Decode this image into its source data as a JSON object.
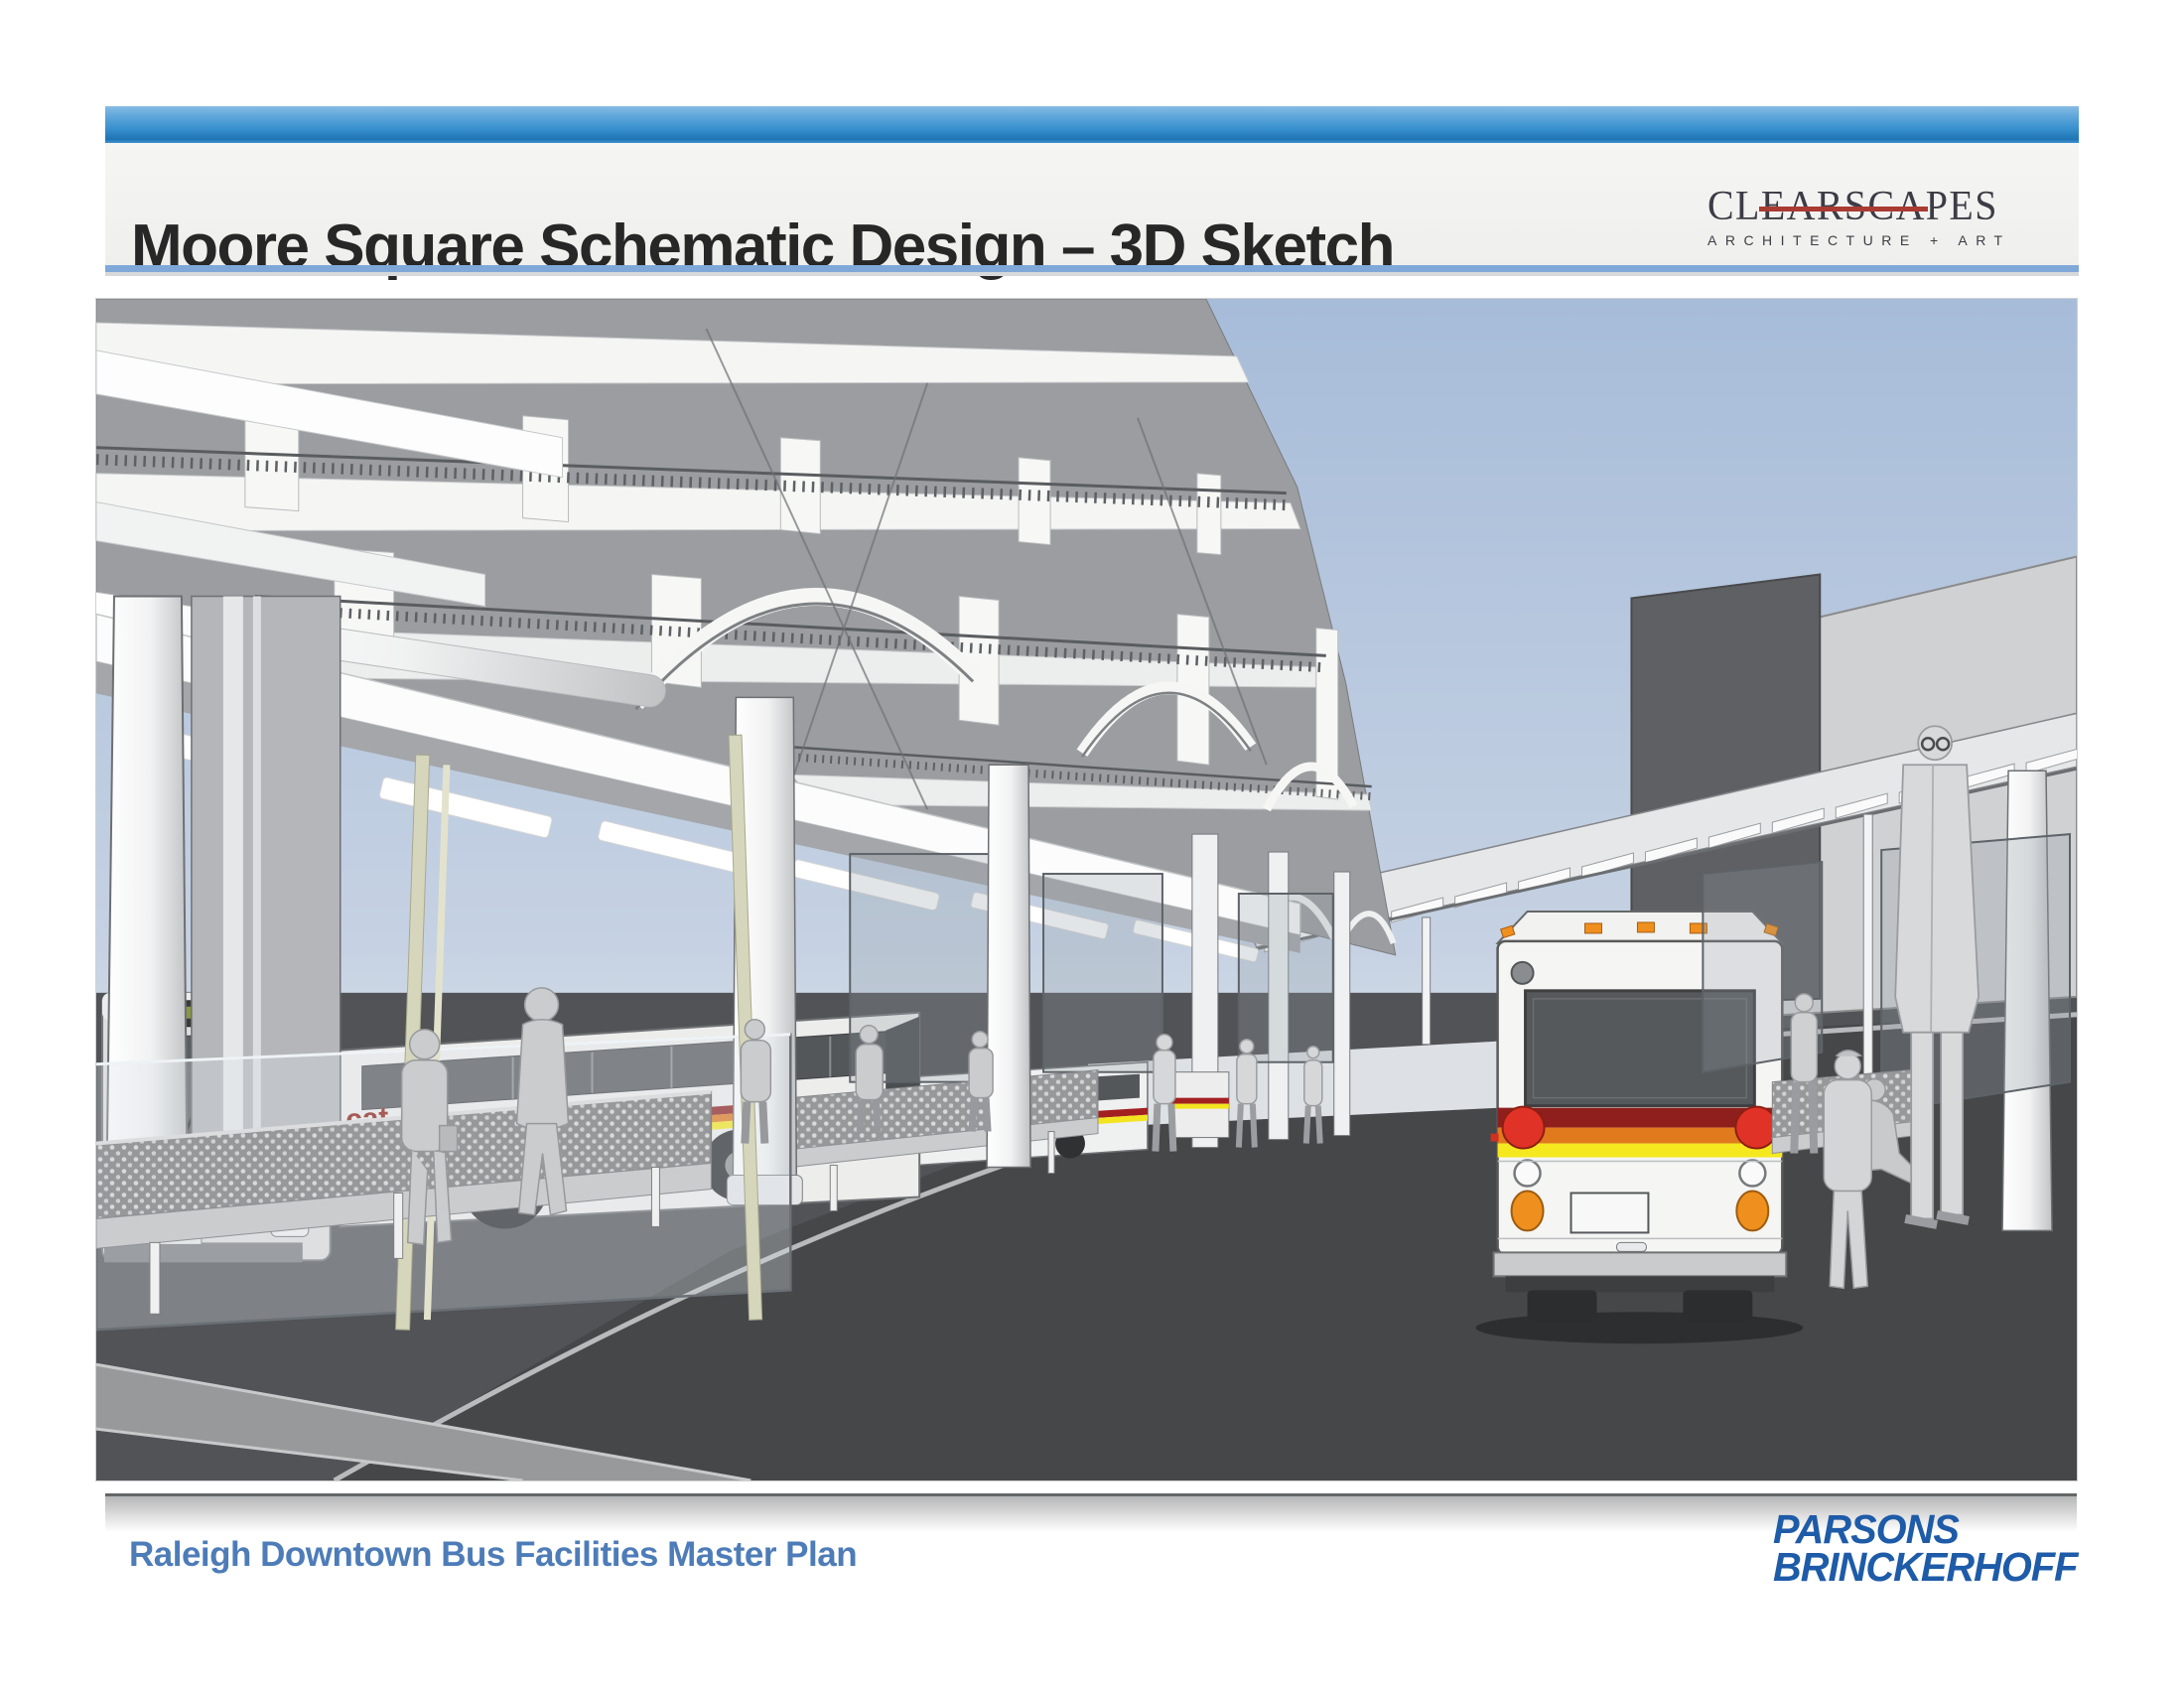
{
  "header": {
    "title": "Moore Square Schematic Design – 3D Sketch"
  },
  "clearscapes_logo": {
    "wordmark": "CLEARSCAPES",
    "tagline": "ARCHITECTURE + ART",
    "accent_color": "#a93b33",
    "text_color": "#3d3c46"
  },
  "sketch": {
    "bus_side_label": "cat"
  },
  "palette": {
    "header_bar_blue": "#3890cd",
    "title_rule_blue": "#7fa8d9",
    "sky_top": "#a7bcd9",
    "road_dark": "#47494b",
    "structure_gray": "#9b9da0",
    "stripe_dark_red": "#8e1f1c",
    "stripe_orange": "#e07a1c",
    "stripe_yellow": "#f5e81f",
    "cat_red": "#8d1d12",
    "tail_light_red": "#e03227",
    "marker_orange": "#ef8f1e"
  },
  "footer": {
    "project": "Raleigh Downtown Bus Facilities Master Plan",
    "text_color": "#4d7cb8"
  },
  "parsons_logo": {
    "line1": "PARSONS",
    "line2": "BRINCKERHOFF",
    "color": "#1e5ba8"
  }
}
